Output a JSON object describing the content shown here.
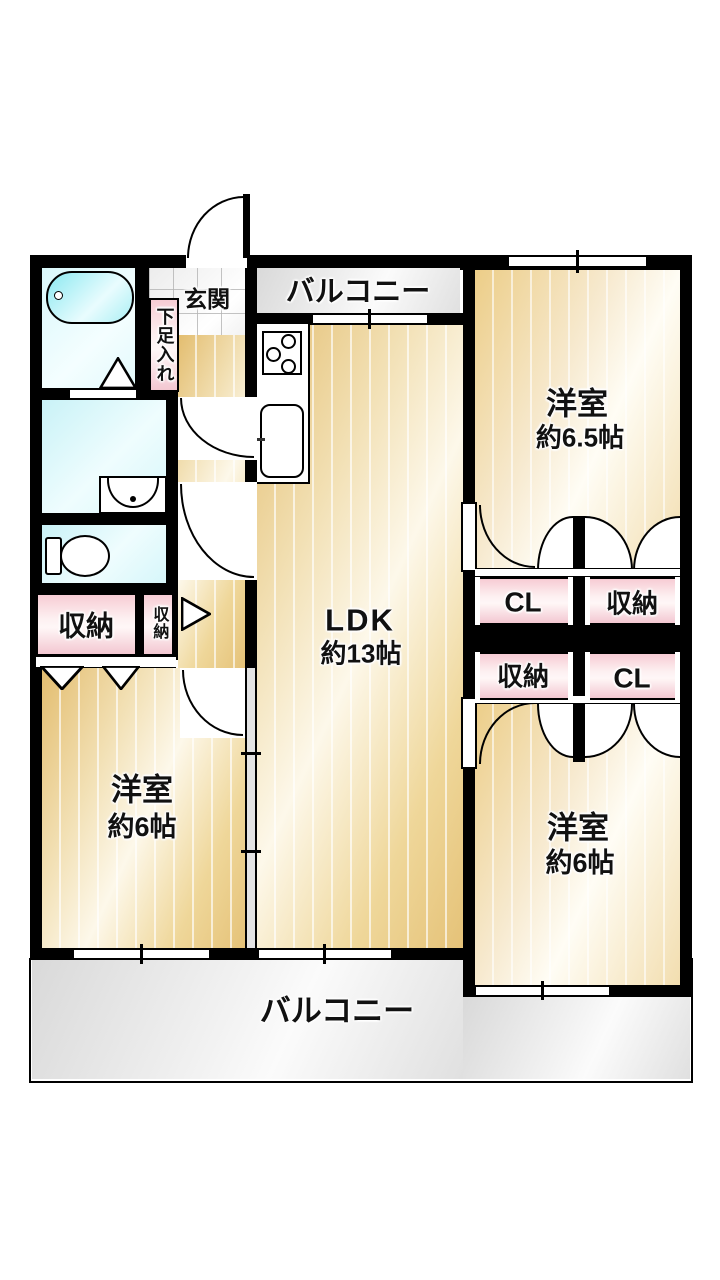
{
  "labels": {
    "balcony_top": "バルコニー",
    "balcony_bottom": "バルコニー",
    "entrance": "玄関",
    "shoe_storage": "下足入れ",
    "room_65": {
      "name": "洋室",
      "size": "約6.5帖"
    },
    "ldk": {
      "name": "LDK",
      "size": "約13帖"
    },
    "room_6_left": {
      "name": "洋室",
      "size": "約6帖"
    },
    "room_6_right": {
      "name": "洋室",
      "size": "約6帖"
    },
    "storage_large": "収納",
    "storage_small": "収納",
    "closet_top_left": "CL",
    "closet_top_right": "収納",
    "closet_bottom_left": "収納",
    "closet_bottom_right": "CL"
  },
  "colors": {
    "wall": "#000000",
    "floor-wood": "#eccf8d",
    "balcony-gray": "#e9e9e9",
    "water-cyan": "#c9f2f7",
    "bathtub-cyan": "#8ce9f1",
    "closet-pink": "#f7ccd4",
    "tile-gray": "#ececec"
  }
}
